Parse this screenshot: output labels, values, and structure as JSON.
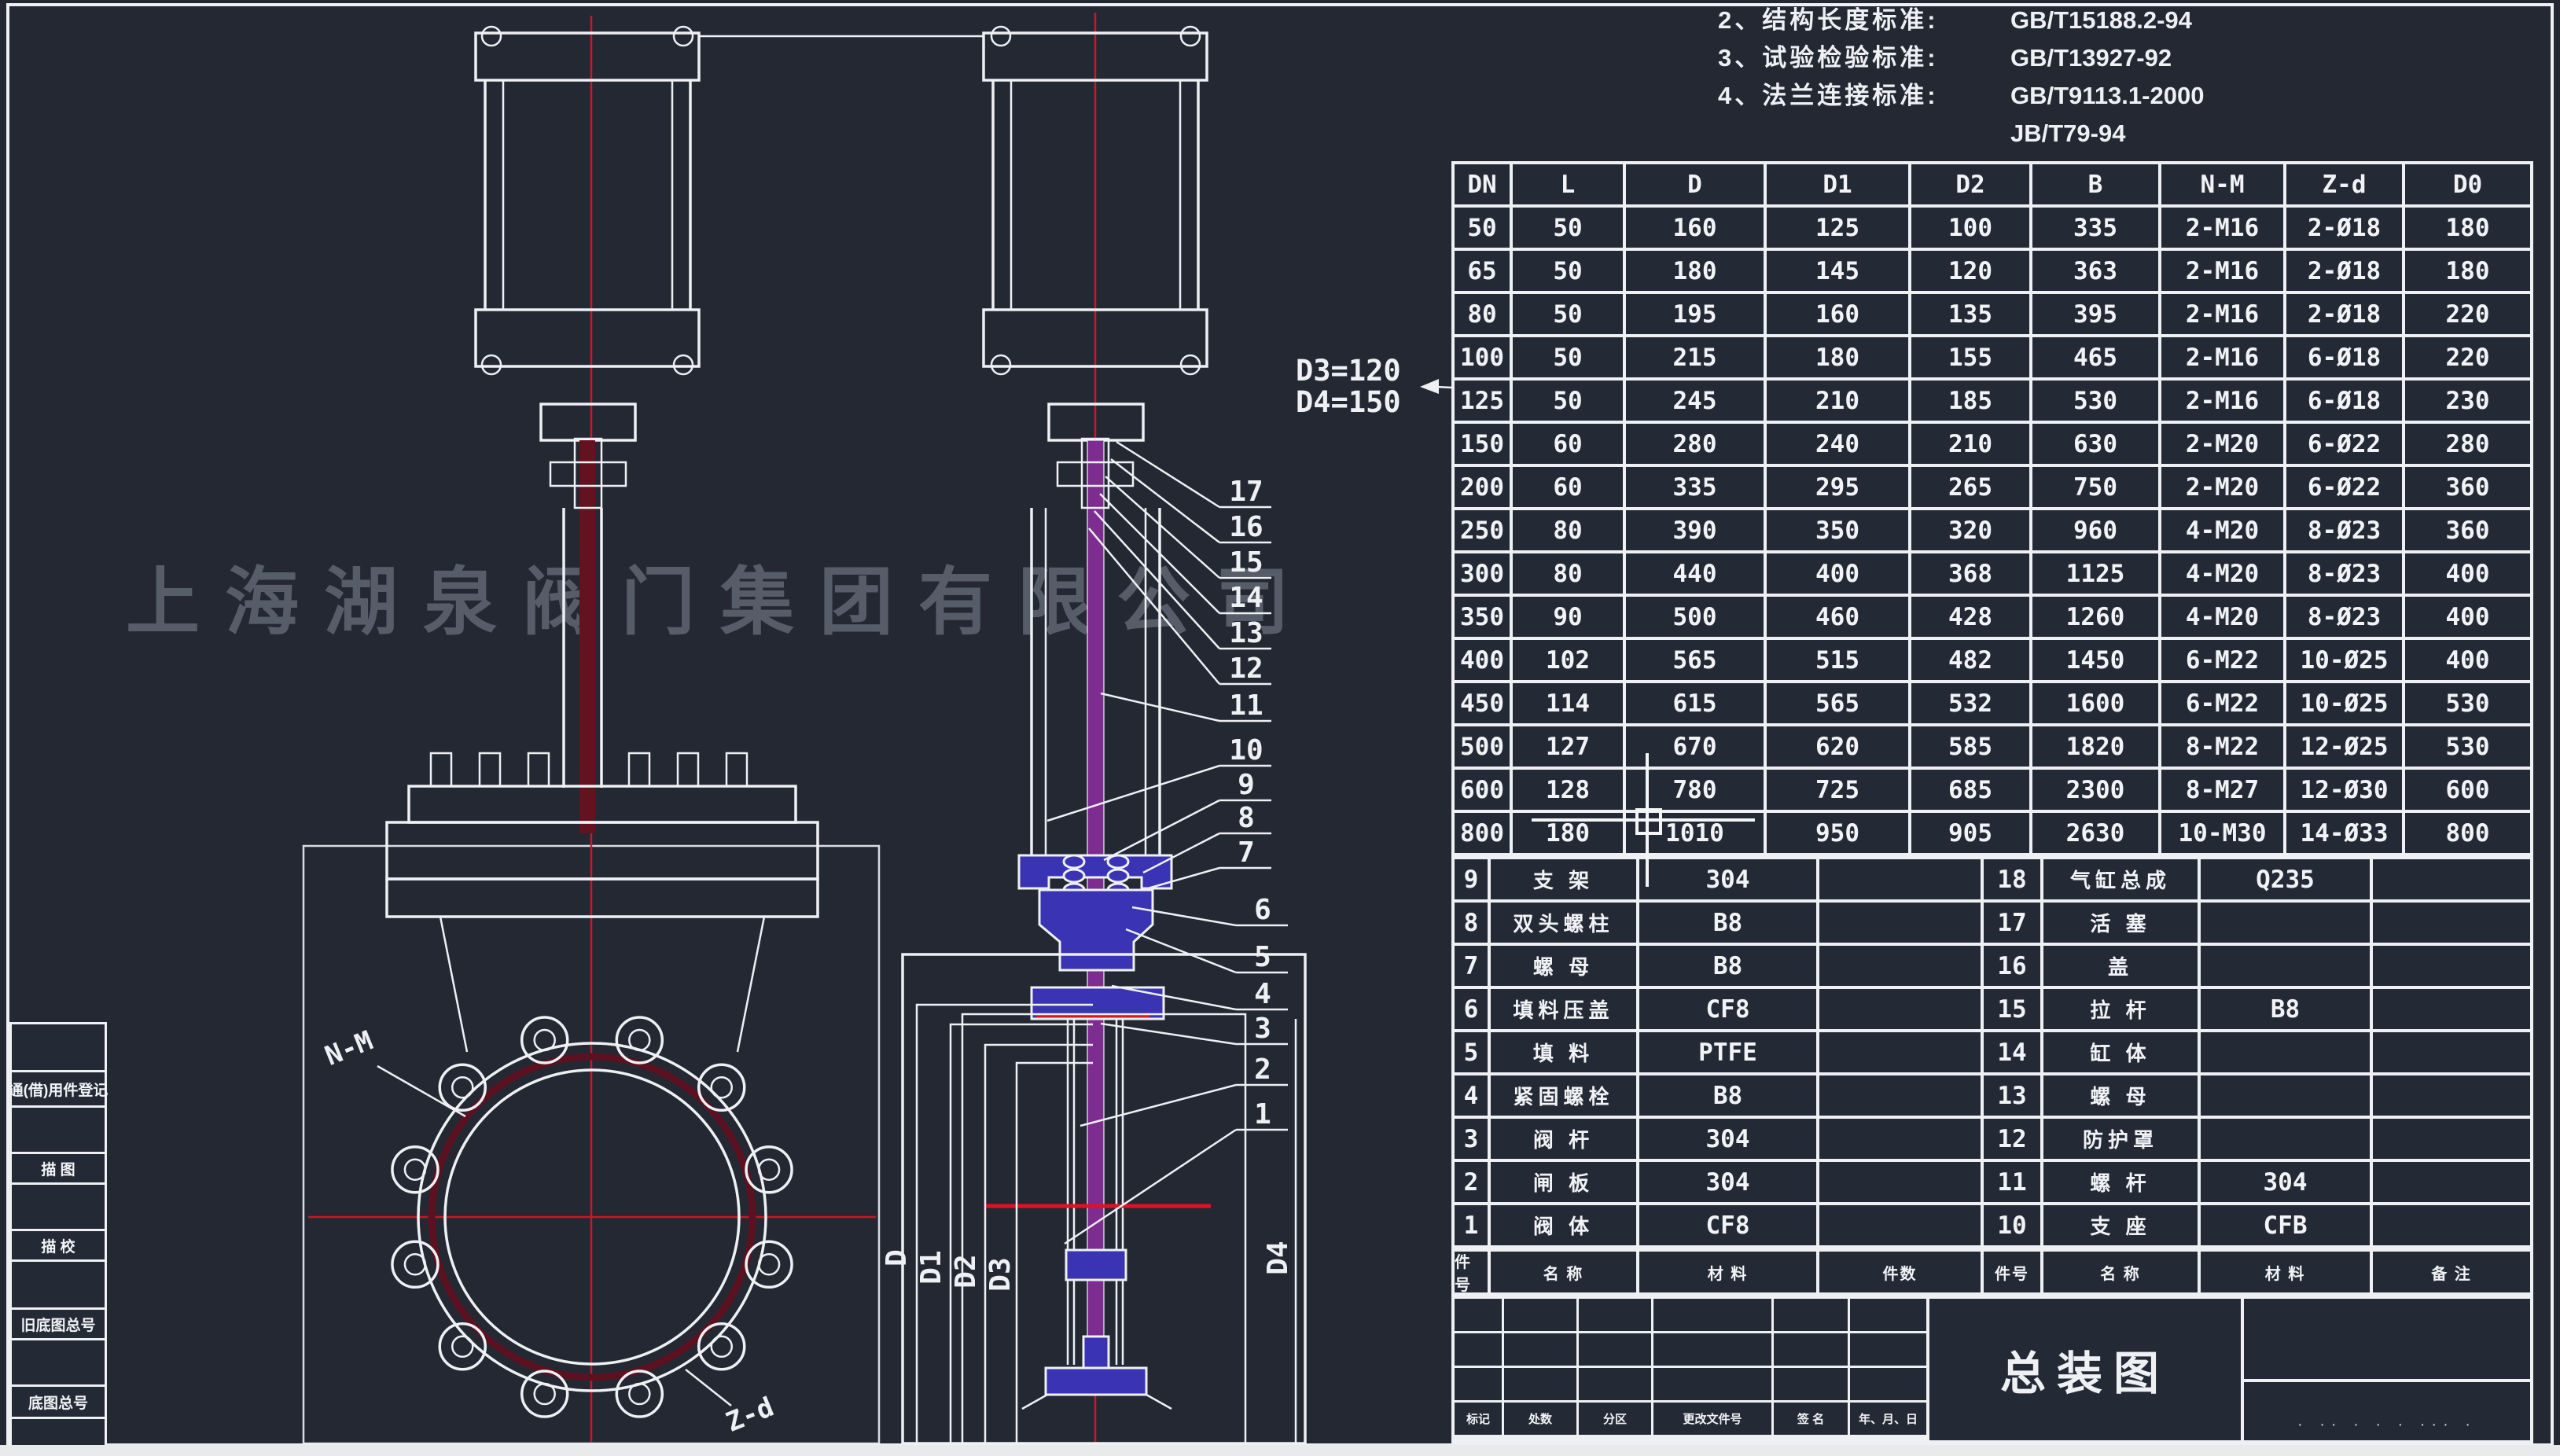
{
  "notes": {
    "lines": [
      {
        "prefix": "2、结构长度标准:",
        "value": "GB/T15188.2-94"
      },
      {
        "prefix": "3、试验检验标准:",
        "value": "GB/T13927-92"
      },
      {
        "prefix": "4、法兰连接标准:",
        "value": "GB/T9113.1-2000"
      },
      {
        "prefix": "",
        "value": "JB/T79-94"
      }
    ]
  },
  "dim_note": {
    "line1": "D3=120",
    "line2": "D4=150"
  },
  "watermark": "上海湖泉阀门集团有限公司",
  "dimension_table": {
    "headers": [
      "DN",
      "L",
      "D",
      "D1",
      "D2",
      "B",
      "N-M",
      "Z-d",
      "D0"
    ],
    "rows": [
      [
        "50",
        "50",
        "160",
        "125",
        "100",
        "335",
        "2-M16",
        "2-Ø18",
        "180"
      ],
      [
        "65",
        "50",
        "180",
        "145",
        "120",
        "363",
        "2-M16",
        "2-Ø18",
        "180"
      ],
      [
        "80",
        "50",
        "195",
        "160",
        "135",
        "395",
        "2-M16",
        "2-Ø18",
        "220"
      ],
      [
        "100",
        "50",
        "215",
        "180",
        "155",
        "465",
        "2-M16",
        "6-Ø18",
        "220"
      ],
      [
        "125",
        "50",
        "245",
        "210",
        "185",
        "530",
        "2-M16",
        "6-Ø18",
        "230"
      ],
      [
        "150",
        "60",
        "280",
        "240",
        "210",
        "630",
        "2-M20",
        "6-Ø22",
        "280"
      ],
      [
        "200",
        "60",
        "335",
        "295",
        "265",
        "750",
        "2-M20",
        "6-Ø22",
        "360"
      ],
      [
        "250",
        "80",
        "390",
        "350",
        "320",
        "960",
        "4-M20",
        "8-Ø23",
        "360"
      ],
      [
        "300",
        "80",
        "440",
        "400",
        "368",
        "1125",
        "4-M20",
        "8-Ø23",
        "400"
      ],
      [
        "350",
        "90",
        "500",
        "460",
        "428",
        "1260",
        "4-M20",
        "8-Ø23",
        "400"
      ],
      [
        "400",
        "102",
        "565",
        "515",
        "482",
        "1450",
        "6-M22",
        "10-Ø25",
        "400"
      ],
      [
        "450",
        "114",
        "615",
        "565",
        "532",
        "1600",
        "6-M22",
        "10-Ø25",
        "530"
      ],
      [
        "500",
        "127",
        "670",
        "620",
        "585",
        "1820",
        "8-M22",
        "12-Ø25",
        "530"
      ],
      [
        "600",
        "128",
        "780",
        "725",
        "685",
        "2300",
        "8-M27",
        "12-Ø30",
        "600"
      ],
      [
        "800",
        "180",
        "1010",
        "950",
        "905",
        "2630",
        "10-M30",
        "14-Ø33",
        "800"
      ]
    ]
  },
  "bom": {
    "left_rows": [
      {
        "no": "9",
        "name": "支 架",
        "material": "304"
      },
      {
        "no": "8",
        "name": "双头螺柱",
        "material": "B8"
      },
      {
        "no": "7",
        "name": "螺 母",
        "material": "B8"
      },
      {
        "no": "6",
        "name": "填料压盖",
        "material": "CF8"
      },
      {
        "no": "5",
        "name": "填 料",
        "material": "PTFE"
      },
      {
        "no": "4",
        "name": "紧固螺栓",
        "material": "B8"
      },
      {
        "no": "3",
        "name": "阀 杆",
        "material": "304"
      },
      {
        "no": "2",
        "name": "闸 板",
        "material": "304"
      },
      {
        "no": "1",
        "name": "阀 体",
        "material": "CF8"
      }
    ],
    "right_rows": [
      {
        "no": "18",
        "name": "气缸总成",
        "material": "Q235"
      },
      {
        "no": "17",
        "name": "活 塞",
        "material": ""
      },
      {
        "no": "16",
        "name": "盖",
        "material": ""
      },
      {
        "no": "15",
        "name": "拉 杆",
        "material": "B8"
      },
      {
        "no": "14",
        "name": "缸 体",
        "material": ""
      },
      {
        "no": "13",
        "name": "螺 母",
        "material": ""
      },
      {
        "no": "12",
        "name": "防护罩",
        "material": ""
      },
      {
        "no": "11",
        "name": "螺 杆",
        "material": "304"
      },
      {
        "no": "10",
        "name": "支 座",
        "material": "CFB"
      }
    ],
    "footer_headers": [
      "件号",
      "名 称",
      "材 料",
      "件数",
      "件号",
      "名 称",
      "材 料",
      "备 注"
    ]
  },
  "title_block": {
    "drawing_title": "总装图",
    "revision_labels": [
      "标记",
      "处数",
      "分区",
      "更改文件号",
      "签 名",
      "年、月、日"
    ],
    "bottom_dots": "· ·· · · · ··· ·"
  },
  "margin_boxes": [
    "通(借)用件登记",
    "描 图",
    "描 校",
    "旧底图总号",
    "底图总号"
  ],
  "callouts": [
    "17",
    "16",
    "15",
    "14",
    "13",
    "12",
    "11",
    "10",
    "9",
    "8",
    "7",
    "6",
    "5",
    "4",
    "3",
    "2",
    "1"
  ],
  "dim_labels": {
    "front_bolt_thread": "N-M",
    "front_bolt_holes": "Z-d",
    "section": [
      "D",
      "D1",
      "D2",
      "D3",
      "D4"
    ]
  },
  "colors": {
    "background": "#232833",
    "line_white": "#eef0f3",
    "centerline_red": "#cf1426",
    "body_fill_blue": "#3a34b4",
    "stem_maroon": "#63121f",
    "stem_purple": "#7c2d8f",
    "watermark_gray": "#9ea5b2",
    "paper_strip": "#e9eaec"
  }
}
